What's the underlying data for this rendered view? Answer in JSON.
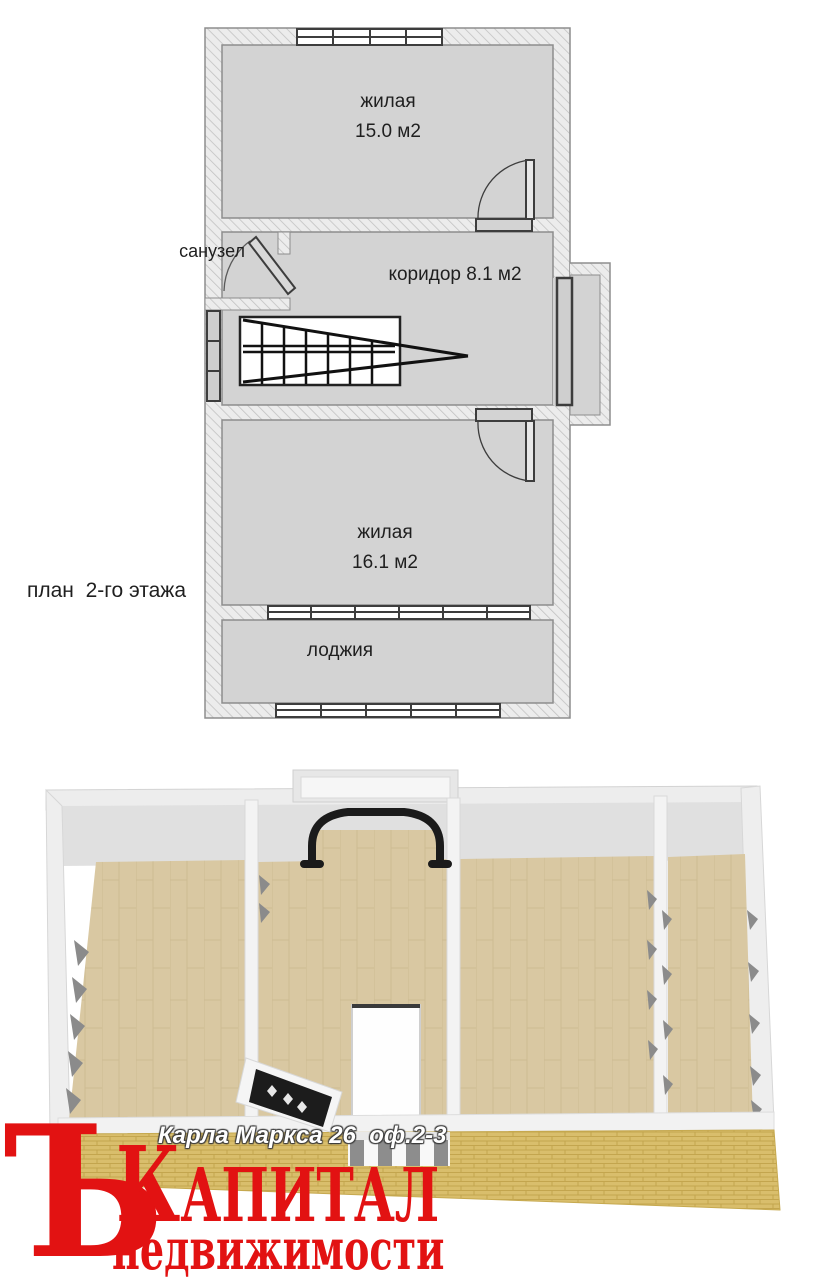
{
  "plan2d": {
    "caption": "план  2-го этажа",
    "room_top_name": "жилая",
    "room_top_area": "15.0 м2",
    "bathroom_label": "санузел",
    "corridor_label": "коридор 8.1 м2",
    "room_bottom_name": "жилая",
    "room_bottom_area": "16.1 м2",
    "loggia_label": "лоджия"
  },
  "watermark": {
    "address": "Карла Маркса 26  оф.2-3",
    "logo_hard_sign": "Ъ",
    "logo_word_initial": "К",
    "logo_word_rest": "апитал",
    "logo_subtitle": "недвижимости",
    "logo_color": "#e21212"
  },
  "colors": {
    "plan_room_fill": "#d3d3d3",
    "plan_wall_hatch_bg": "#ececec",
    "plan_line": "#3d3d3d",
    "wood_floor": "#d9c8a2",
    "brick_front_wall": "#d9be6c",
    "wall_white": "#f3f3f3"
  }
}
